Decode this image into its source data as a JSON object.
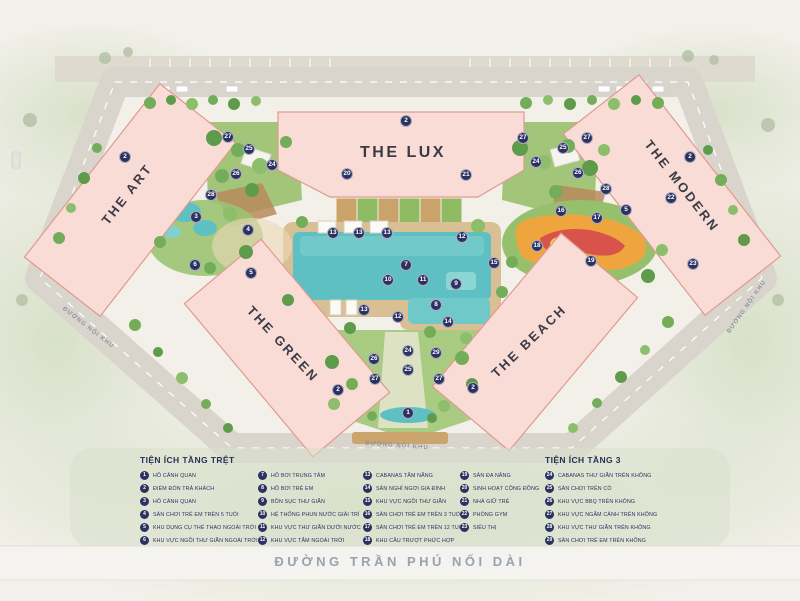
{
  "map": {
    "buildings": [
      {
        "name": "THE ART",
        "x": 127,
        "y": 194,
        "rotate": -52,
        "size": 13
      },
      {
        "name": "THE LUX",
        "x": 403,
        "y": 153,
        "rotate": 0,
        "size": 16
      },
      {
        "name": "THE MODERN",
        "x": 682,
        "y": 186,
        "rotate": 52,
        "size": 13
      },
      {
        "name": "THE GREEN",
        "x": 283,
        "y": 344,
        "rotate": 47,
        "size": 13
      },
      {
        "name": "THE BEACH",
        "x": 529,
        "y": 341,
        "rotate": -44,
        "size": 13
      }
    ],
    "street_labels": [
      {
        "text": "ĐƯỜNG NỘI KHU",
        "x": 88,
        "y": 328,
        "rotate": 38
      },
      {
        "text": "ĐƯỜNG NỘI KHU",
        "x": 747,
        "y": 307,
        "rotate": -55
      },
      {
        "text": "ĐƯỜNG NỘI KHU",
        "x": 397,
        "y": 446,
        "rotate": 4
      }
    ],
    "main_street": "ĐƯỜNG TRẦN PHÚ NỐI DÀI",
    "markers": [
      {
        "n": "2",
        "x": 125,
        "y": 157
      },
      {
        "n": "27",
        "x": 228,
        "y": 137
      },
      {
        "n": "25",
        "x": 249,
        "y": 149
      },
      {
        "n": "24",
        "x": 272,
        "y": 165
      },
      {
        "n": "26",
        "x": 236,
        "y": 174
      },
      {
        "n": "28",
        "x": 211,
        "y": 195
      },
      {
        "n": "3",
        "x": 196,
        "y": 217
      },
      {
        "n": "4",
        "x": 248,
        "y": 230
      },
      {
        "n": "6",
        "x": 195,
        "y": 265
      },
      {
        "n": "5",
        "x": 251,
        "y": 273
      },
      {
        "n": "2",
        "x": 406,
        "y": 121
      },
      {
        "n": "20",
        "x": 347,
        "y": 174
      },
      {
        "n": "21",
        "x": 466,
        "y": 175
      },
      {
        "n": "13",
        "x": 333,
        "y": 233
      },
      {
        "n": "13",
        "x": 359,
        "y": 233
      },
      {
        "n": "13",
        "x": 387,
        "y": 233
      },
      {
        "n": "12",
        "x": 462,
        "y": 237
      },
      {
        "n": "7",
        "x": 406,
        "y": 265
      },
      {
        "n": "15",
        "x": 494,
        "y": 263
      },
      {
        "n": "10",
        "x": 388,
        "y": 280
      },
      {
        "n": "11",
        "x": 423,
        "y": 280
      },
      {
        "n": "9",
        "x": 456,
        "y": 284
      },
      {
        "n": "8",
        "x": 436,
        "y": 305
      },
      {
        "n": "13",
        "x": 364,
        "y": 310
      },
      {
        "n": "12",
        "x": 398,
        "y": 317
      },
      {
        "n": "14",
        "x": 448,
        "y": 322
      },
      {
        "n": "27",
        "x": 523,
        "y": 138
      },
      {
        "n": "27",
        "x": 587,
        "y": 138
      },
      {
        "n": "25",
        "x": 563,
        "y": 148
      },
      {
        "n": "24",
        "x": 536,
        "y": 162
      },
      {
        "n": "26",
        "x": 578,
        "y": 173
      },
      {
        "n": "28",
        "x": 606,
        "y": 189
      },
      {
        "n": "2",
        "x": 690,
        "y": 157
      },
      {
        "n": "22",
        "x": 671,
        "y": 198
      },
      {
        "n": "16",
        "x": 561,
        "y": 211
      },
      {
        "n": "5",
        "x": 626,
        "y": 210
      },
      {
        "n": "17",
        "x": 597,
        "y": 218
      },
      {
        "n": "18",
        "x": 537,
        "y": 246
      },
      {
        "n": "19",
        "x": 591,
        "y": 261
      },
      {
        "n": "23",
        "x": 693,
        "y": 264
      },
      {
        "n": "24",
        "x": 408,
        "y": 351
      },
      {
        "n": "26",
        "x": 374,
        "y": 359
      },
      {
        "n": "25",
        "x": 408,
        "y": 370
      },
      {
        "n": "27",
        "x": 375,
        "y": 379
      },
      {
        "n": "29",
        "x": 436,
        "y": 353
      },
      {
        "n": "27",
        "x": 439,
        "y": 379
      },
      {
        "n": "2",
        "x": 338,
        "y": 390
      },
      {
        "n": "2",
        "x": 473,
        "y": 388
      },
      {
        "n": "1",
        "x": 408,
        "y": 413
      }
    ]
  },
  "legend": {
    "ground_title": "TIỆN ÍCH TẦNG TRỆT",
    "floor3_title": "TIỆN ÍCH TẦNG 3",
    "col1": [
      {
        "n": "1",
        "label": "HỒ CẢNH QUAN"
      },
      {
        "n": "2",
        "label": "ĐIỂM ĐÓN TRẢ KHÁCH"
      },
      {
        "n": "3",
        "label": "HỒ CẢNH QUAN"
      },
      {
        "n": "4",
        "label": "SÂN CHƠI TRẺ EM TRÊN 5 TUỔI"
      },
      {
        "n": "5",
        "label": "KHU DỤNG CỤ THỂ THAO NGOÀI TRỜI"
      },
      {
        "n": "6",
        "label": "KHU VỰC NGỒI THƯ GIÃN NGOÀI TRỜI"
      }
    ],
    "col2": [
      {
        "n": "7",
        "label": "HỒ BƠI TRUNG TÂM"
      },
      {
        "n": "8",
        "label": "HỒ BƠI TRẺ EM"
      },
      {
        "n": "9",
        "label": "BỒN SỤC THƯ GIÃN"
      },
      {
        "n": "10",
        "label": "HỆ THỐNG PHUN NƯỚC GIẢI TRÍ"
      },
      {
        "n": "11",
        "label": "KHU VỰC THƯ GIÃN DƯỚI NƯỚC"
      },
      {
        "n": "12",
        "label": "KHU VỰC TẮM NGOÀI TRỜI"
      }
    ],
    "col3": [
      {
        "n": "13",
        "label": "CABANAS TẮM NẮNG"
      },
      {
        "n": "14",
        "label": "SÂN NGHỈ NGƠI GIA ĐÌNH"
      },
      {
        "n": "15",
        "label": "KHU VỰC NGỒI THƯ GIÃN"
      },
      {
        "n": "16",
        "label": "SÂN CHƠI TRẺ EM TRÊN 3 TUỔI"
      },
      {
        "n": "17",
        "label": "SÂN CHƠI TRẺ EM TRÊN 12 TUỔI"
      },
      {
        "n": "18",
        "label": "KHU CẦU TRƯỢT PHỨC HỢP"
      }
    ],
    "col4": [
      {
        "n": "19",
        "label": "SÂN ĐA NĂNG"
      },
      {
        "n": "20",
        "label": "SINH HOẠT CỘNG ĐỒNG"
      },
      {
        "n": "21",
        "label": "NHÀ GIỮ TRẺ"
      },
      {
        "n": "22",
        "label": "PHÒNG GYM"
      },
      {
        "n": "23",
        "label": "SIÊU THỊ"
      }
    ],
    "col5": [
      {
        "n": "24",
        "label": "CABANAS THƯ GIÃN TRÊN KHÔNG"
      },
      {
        "n": "25",
        "label": "SÂN CHƠI TRÊN CỎ"
      },
      {
        "n": "26",
        "label": "KHU VỰC BBQ TRÊN KHÔNG"
      },
      {
        "n": "27",
        "label": "KHU VỰC NGẮM CẢNH TRÊN KHÔNG"
      },
      {
        "n": "28",
        "label": "KHU VỰC THƯ GIÃN TRÊN KHÔNG"
      },
      {
        "n": "29",
        "label": "SÂN CHƠI TRẺ EM TRÊN KHÔNG"
      }
    ]
  },
  "colors": {
    "marker_bg": "#2b3160",
    "building_fill": "#f9dcd6",
    "building_outline": "#e09a90",
    "pool": "#5fc0c3",
    "legend_text": "#2b3160",
    "street_text": "#99a2af"
  }
}
